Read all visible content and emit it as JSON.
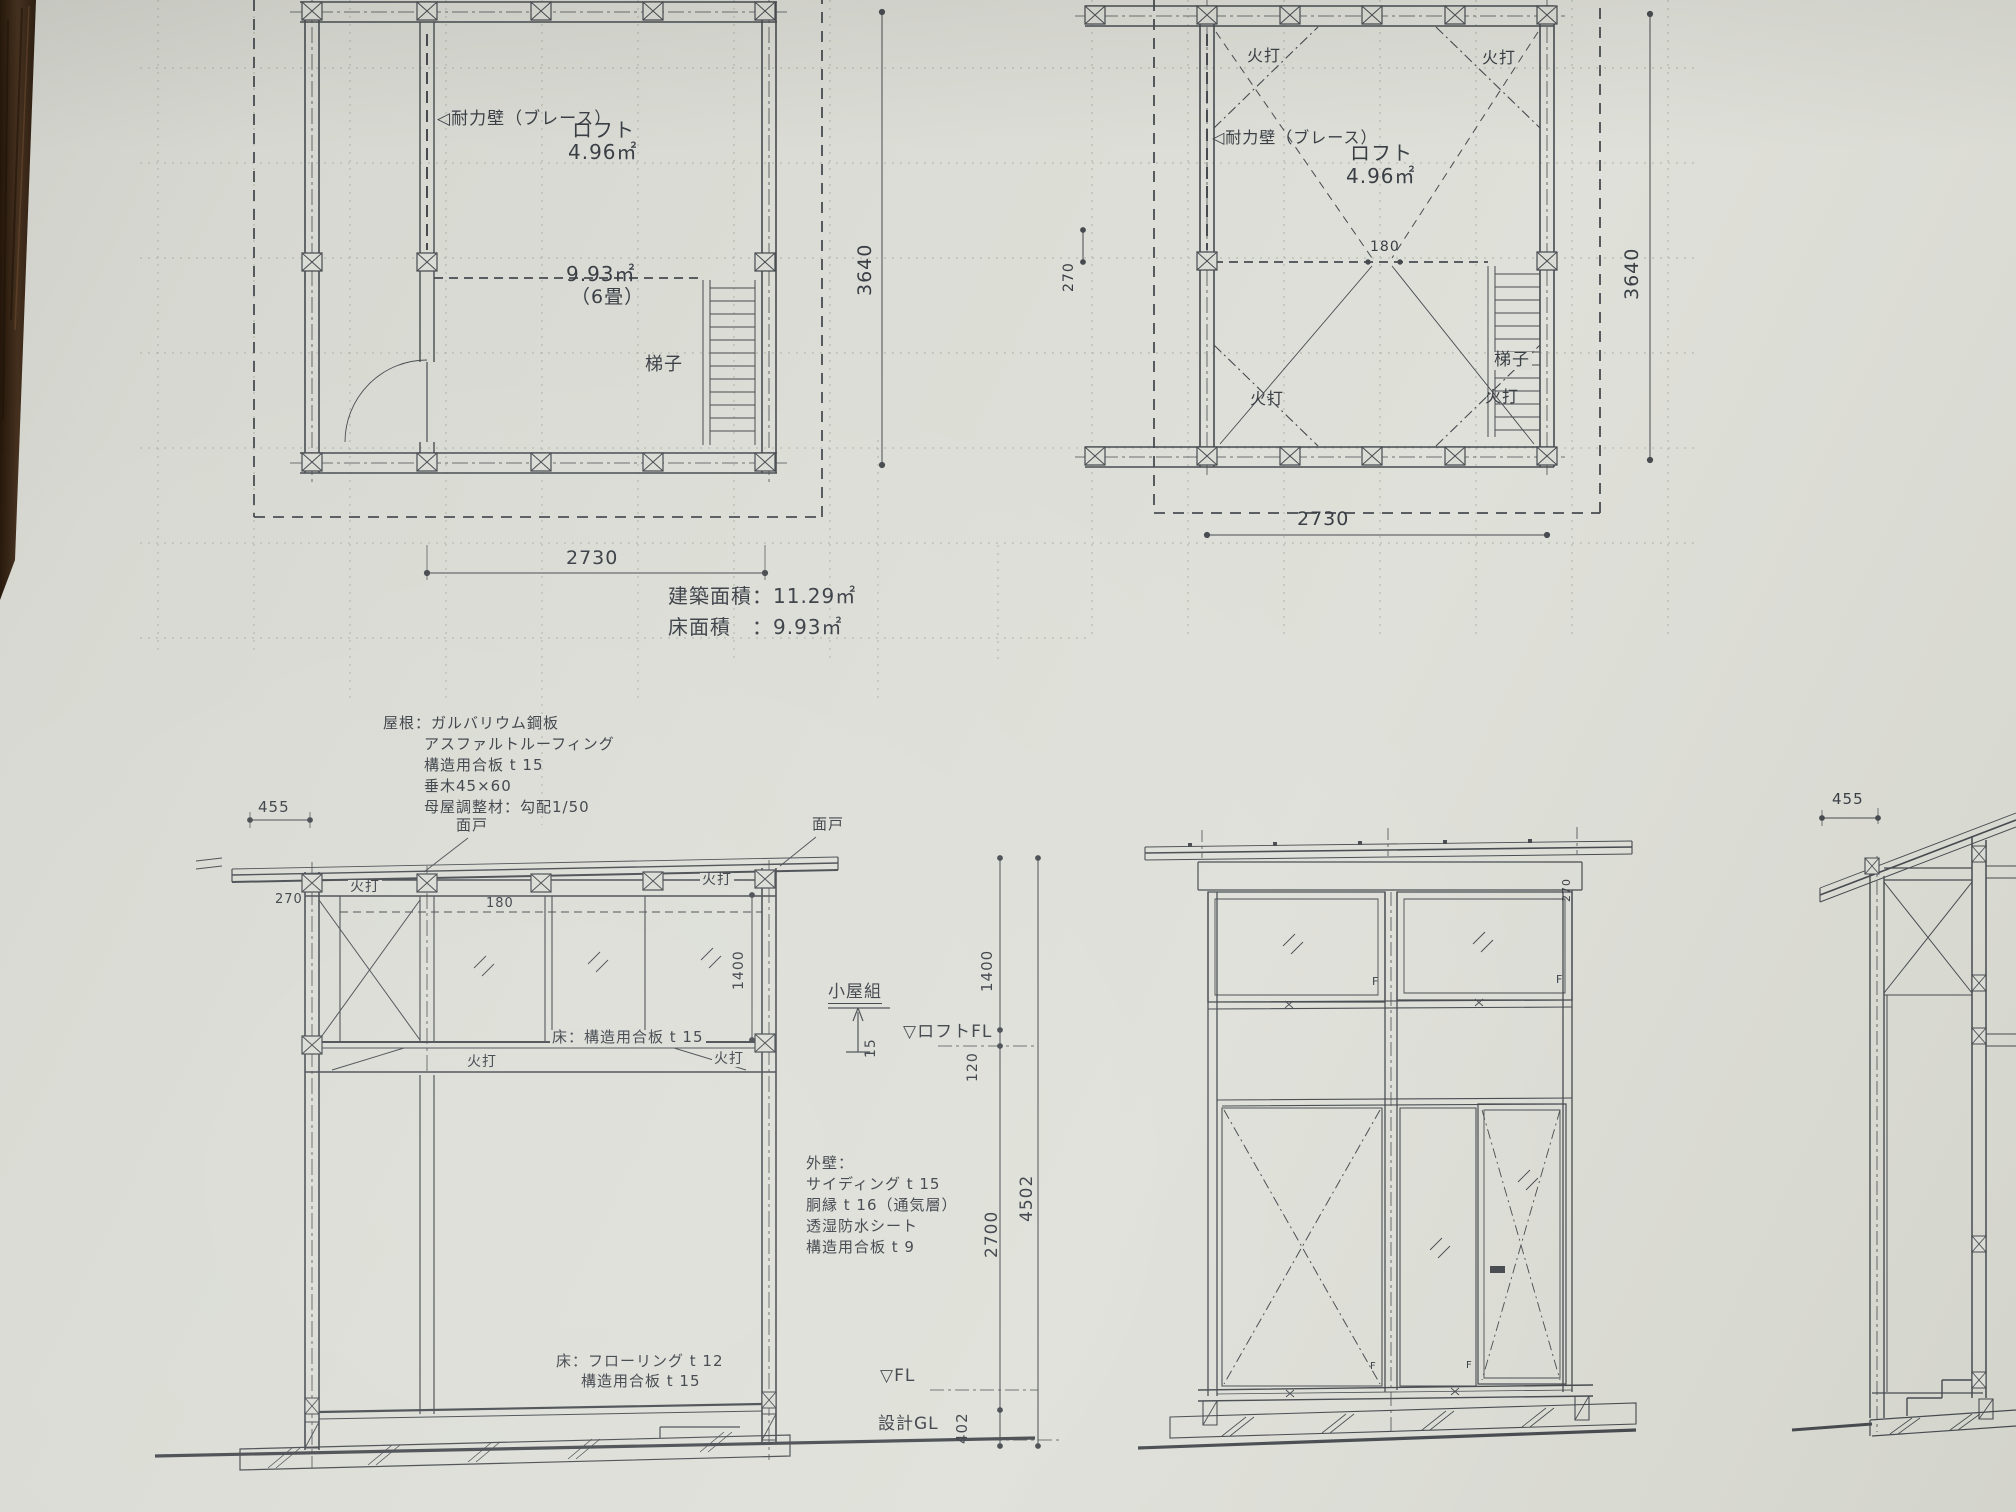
{
  "palette": {
    "paper": "#dbdcd5",
    "line": "#474b50",
    "text": "#3a3f46",
    "wood": "#35241a"
  },
  "plan_left": {
    "brace_wall_label": "◁耐力壁（ブレース）",
    "loft_label": "ロフト",
    "loft_area": "4.96㎡",
    "room_area": "9.93㎡",
    "room_size": "（6畳）",
    "ladder_label": "梯子",
    "width_dim": "2730",
    "height_dim": "3640"
  },
  "plan_right": {
    "hiuchi_top_left": "火打",
    "hiuchi_top_right": "火打",
    "hiuchi_bottom_left": "火打",
    "hiuchi_bottom_right": "火打",
    "brace_wall_label": "◁耐力壁（ブレース）",
    "loft_label": "ロフト",
    "loft_area": "4.96㎡",
    "dim_180": "180",
    "dim_270": "270",
    "ladder_label": "梯子",
    "width_dim": "2730",
    "height_dim": "3640"
  },
  "area_table": {
    "building_area": "建築面積：11.29㎡",
    "floor_area": "床面積　：9.93㎡"
  },
  "roof_spec": {
    "line1": "屋根：ガルバリウム鋼板",
    "line2": "アスファルトルーフィング",
    "line3": "構造用合板 t 15",
    "line4": "垂木45×60",
    "line5": "母屋調整材：勾配1/50"
  },
  "section_left": {
    "dim_455": "455",
    "mendo_left": "面戸",
    "mendo_right": "面戸",
    "dim_270": "270",
    "hiuchi_roof_left": "火打",
    "hiuchi_roof_right": "火打",
    "dim_180": "180",
    "dim_1400_inner": "1400",
    "loft_floor_label": "床：構造用合板 t 15",
    "hiuchi_floor_left": "火打",
    "hiuchi_floor_right": "火打",
    "koyagumi_label": "小屋組",
    "dim_15": "15",
    "loft_fl_label": "▽ロフトFL",
    "dim_120": "120",
    "dim_1400": "1400",
    "dim_2700": "2700",
    "dim_4502": "4502",
    "dim_402": "402",
    "wall_spec_title": "外壁：",
    "wall_spec_line1": "サイディング t 15",
    "wall_spec_line2": "胴縁 t 16（通気層）",
    "wall_spec_line3": "透湿防水シート",
    "wall_spec_line4": "構造用合板 t 9",
    "floor_spec_line1": "床：フローリング t 12",
    "floor_spec_line2": "構造用合板 t 15",
    "fl_label": "▽FL",
    "gl_label": "設計GL"
  },
  "elevation": {
    "dim_270": "270",
    "f_top_left": "F",
    "f_top_right": "F",
    "f_bottom_left": "F",
    "f_bottom_right": "F"
  },
  "section_right": {
    "dim_455": "455"
  }
}
